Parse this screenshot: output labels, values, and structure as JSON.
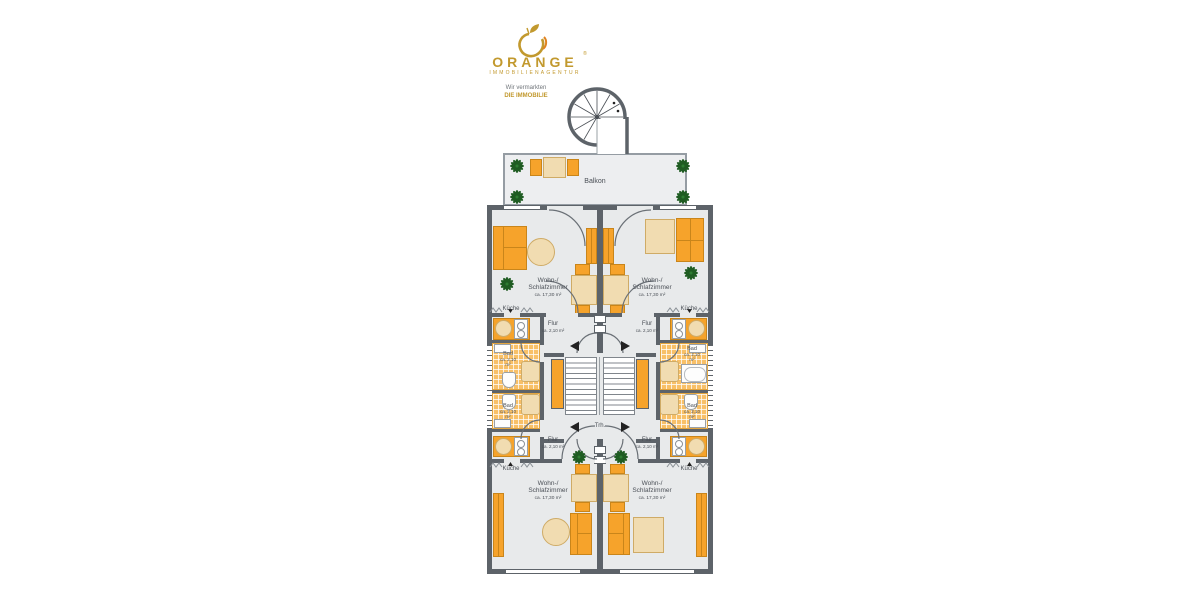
{
  "brand": {
    "name": "ORANGE",
    "mark": "®",
    "subtitle": "IMMOBILIENAGENTUR",
    "tagline1": "Wir vermarkten",
    "tagline2": "DIE IMMOBILIE"
  },
  "plan": {
    "balcony": "Balkon",
    "stairwell": "Trh.",
    "living": {
      "line1": "Wohn-/",
      "line2": "Schlafzimmer",
      "area": "ca. 17,30 m²"
    },
    "kitchen": "Küche",
    "hall": {
      "line1": "Flur",
      "area": "ca. 2,10 m²"
    },
    "bath": {
      "line1": "Bad",
      "area": "ca. 2,10",
      "unit": "m²"
    }
  },
  "colors": {
    "wall": "#5d6369",
    "floor": "#e8eaeb",
    "accent_orange": "#f6a32b",
    "wood": "#f1dcb1",
    "tile": "#f8c068",
    "plant": "#1f5c22",
    "brand_gold": "#c2992e"
  }
}
